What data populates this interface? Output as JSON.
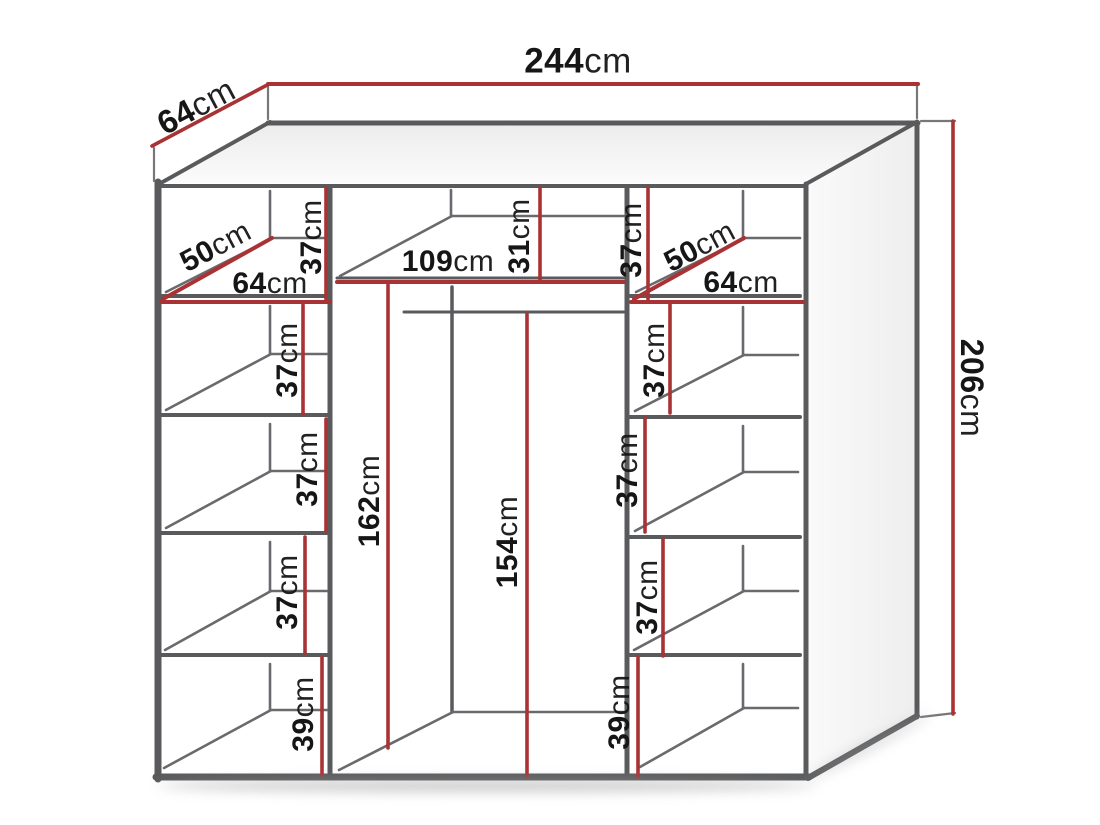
{
  "diagram_type": "wardrobe-dimension-drawing",
  "unit": "cm",
  "overall": {
    "width": {
      "num": "244",
      "unit": "cm"
    },
    "depth": {
      "num": "64",
      "unit": "cm"
    },
    "height": {
      "num": "206",
      "unit": "cm"
    }
  },
  "left": {
    "shelf_depth": {
      "num": "50",
      "unit": "cm"
    },
    "shelf_width": {
      "num": "64",
      "unit": "cm"
    },
    "comps": [
      {
        "num": "37",
        "unit": "cm"
      },
      {
        "num": "37",
        "unit": "cm"
      },
      {
        "num": "37",
        "unit": "cm"
      },
      {
        "num": "37",
        "unit": "cm"
      },
      {
        "num": "39",
        "unit": "cm"
      }
    ]
  },
  "center": {
    "shelf_width": {
      "num": "109",
      "unit": "cm"
    },
    "top_height": {
      "num": "31",
      "unit": "cm"
    },
    "left_height": {
      "num": "162",
      "unit": "cm"
    },
    "rail_height": {
      "num": "154",
      "unit": "cm"
    }
  },
  "right": {
    "shelf_depth": {
      "num": "50",
      "unit": "cm"
    },
    "shelf_width": {
      "num": "64",
      "unit": "cm"
    },
    "comps": [
      {
        "num": "37",
        "unit": "cm"
      },
      {
        "num": "37",
        "unit": "cm"
      },
      {
        "num": "37",
        "unit": "cm"
      },
      {
        "num": "37",
        "unit": "cm"
      },
      {
        "num": "39",
        "unit": "cm"
      }
    ]
  },
  "colors": {
    "cabinet_line": "#595a5c",
    "detail_line": "#6a6a6e",
    "dimension_red": "#a93234",
    "label_text": "#161616",
    "shadow": "#9b9b9b"
  }
}
